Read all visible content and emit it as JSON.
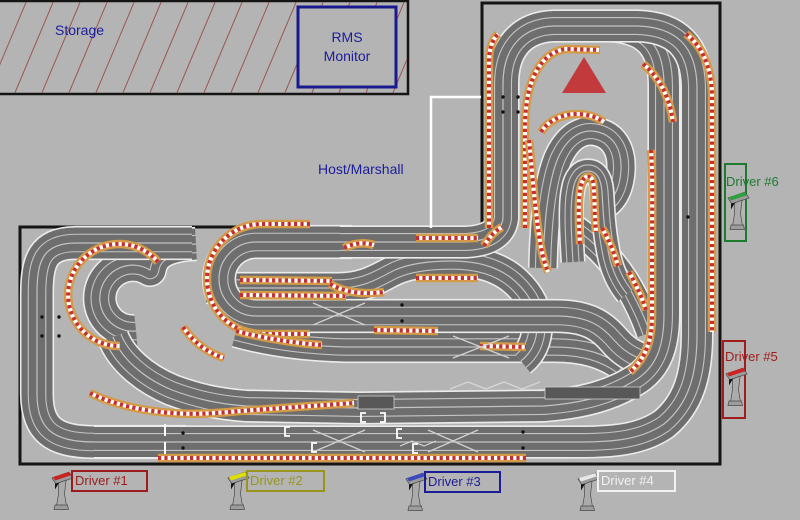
{
  "app": {
    "background": "#b4b4b4",
    "description": "Slot car race track room layout"
  },
  "storage": {
    "label": "Storage",
    "text_color": "#1c1c9c",
    "hatch_color": "#9b5555",
    "border_color": "#151515"
  },
  "rms_monitor": {
    "line1": "RMS",
    "line2": "Monitor",
    "text_color": "#1c1c9c",
    "border_color": "#1a1a8f"
  },
  "host_marshall": {
    "label": "Host/Marshall",
    "text_color": "#1c1c9c",
    "outline_color": "#ffffff"
  },
  "track": {
    "surface_color": "#6e6e6e",
    "edge_color": "#ebebeb",
    "lane_line_color": "#c3c3c3",
    "curb_orange": "#d49a45",
    "curb_red": "#c52f2f",
    "curb_white": "#ffffff",
    "table_border_color": "#151515",
    "direction_marker": {
      "icon": "triangle-up-icon",
      "color": "#c23a3c"
    }
  },
  "drivers": [
    {
      "label": "Driver #1",
      "color": "#9b1c1c",
      "accent": "#cc2222",
      "icon": "controller-icon",
      "position": "bottom"
    },
    {
      "label": "Driver #2",
      "color": "#96961e",
      "accent": "#e0e000",
      "icon": "controller-icon",
      "position": "bottom"
    },
    {
      "label": "Driver #3",
      "color": "#1c1c96",
      "accent": "#3a4ac0",
      "icon": "controller-icon",
      "position": "bottom"
    },
    {
      "label": "Driver #4",
      "color": "#f2f2f2",
      "accent": "#e8e8e8",
      "icon": "controller-icon",
      "position": "bottom"
    },
    {
      "label": "Driver #5",
      "color": "#a01d1d",
      "accent": "#cc2222",
      "icon": "controller-icon",
      "position": "right"
    },
    {
      "label": "Driver #6",
      "color": "#1d7a2e",
      "accent": "#2fa040",
      "icon": "controller-icon",
      "position": "right"
    }
  ]
}
